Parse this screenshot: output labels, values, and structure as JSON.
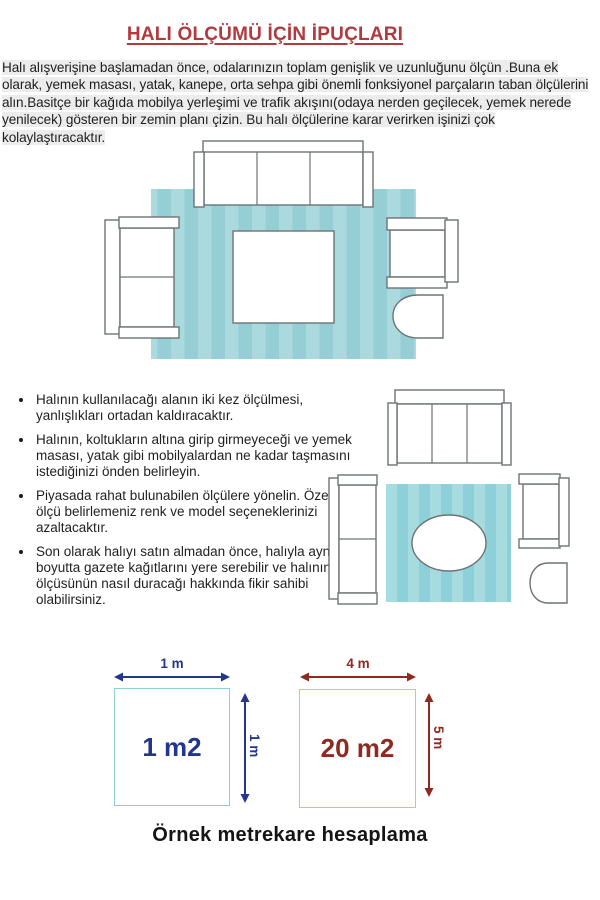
{
  "colors": {
    "title_red": "#b23a3e",
    "text_dark": "#1f1f1f",
    "highlight": "#ececec",
    "outline_gray": "#6d7375",
    "rug1_light": "#abdade",
    "rug1_dark": "#95cfd5",
    "rug2_light": "#a6dbdf",
    "rug2_dark": "#8ed0d7",
    "navy": "#23368f",
    "brick": "#8e2a1f",
    "teal_border": "#8fd0d3",
    "tan_border": "#debb8d"
  },
  "header": {
    "title": "HALI ÖLÇÜMÜ İÇİN İPUÇLARI"
  },
  "intro": {
    "text": "Halı alışverişine başlamadan önce, odalarınızın toplam genişlik ve uzunluğunu ölçün .Buna ek olarak, yemek masası, yatak, kanepe, orta sehpa gibi önemli fonksiyonel parçaların taban ölçülerini alın.Basitçe bir kağıda mobilya yerleşimi ve trafik akışını(odaya nerden geçilecek, yemek nerede yenilecek) gösteren bir zemin planı çizin. Bu halı ölçülerine karar verirken işinizi çok kolaylaştıracaktır."
  },
  "tips": {
    "items": [
      "Halının kullanılacağı alanın iki kez ölçülmesi, yanlışlıkları ortadan kaldıracaktır.",
      "Halının, koltukların altına girip girmeyeceği ve yemek masası, yatak gibi mobilyalardan ne kadar taşmasını istediğinizi önden belirleyin.",
      "Piyasada rahat bulunabilen ölçülere yönelin. Özel bir ölçü belirlemeniz renk ve model seçeneklerinizi azaltacaktır.",
      "Son olarak halıyı satın almadan önce, halıyla aynı boyutta gazete kağıtlarını yere serebilir ve halının ölçüsünün nasıl duracağı hakkında fikir sahibi olabilirsiniz."
    ]
  },
  "calc": {
    "small": {
      "area": "1 m2",
      "top": "1 m",
      "side": "1 m"
    },
    "large": {
      "area": "20 m2",
      "top": "4 m",
      "side": "5 m"
    },
    "caption": "Örnek metrekare hesaplama"
  }
}
